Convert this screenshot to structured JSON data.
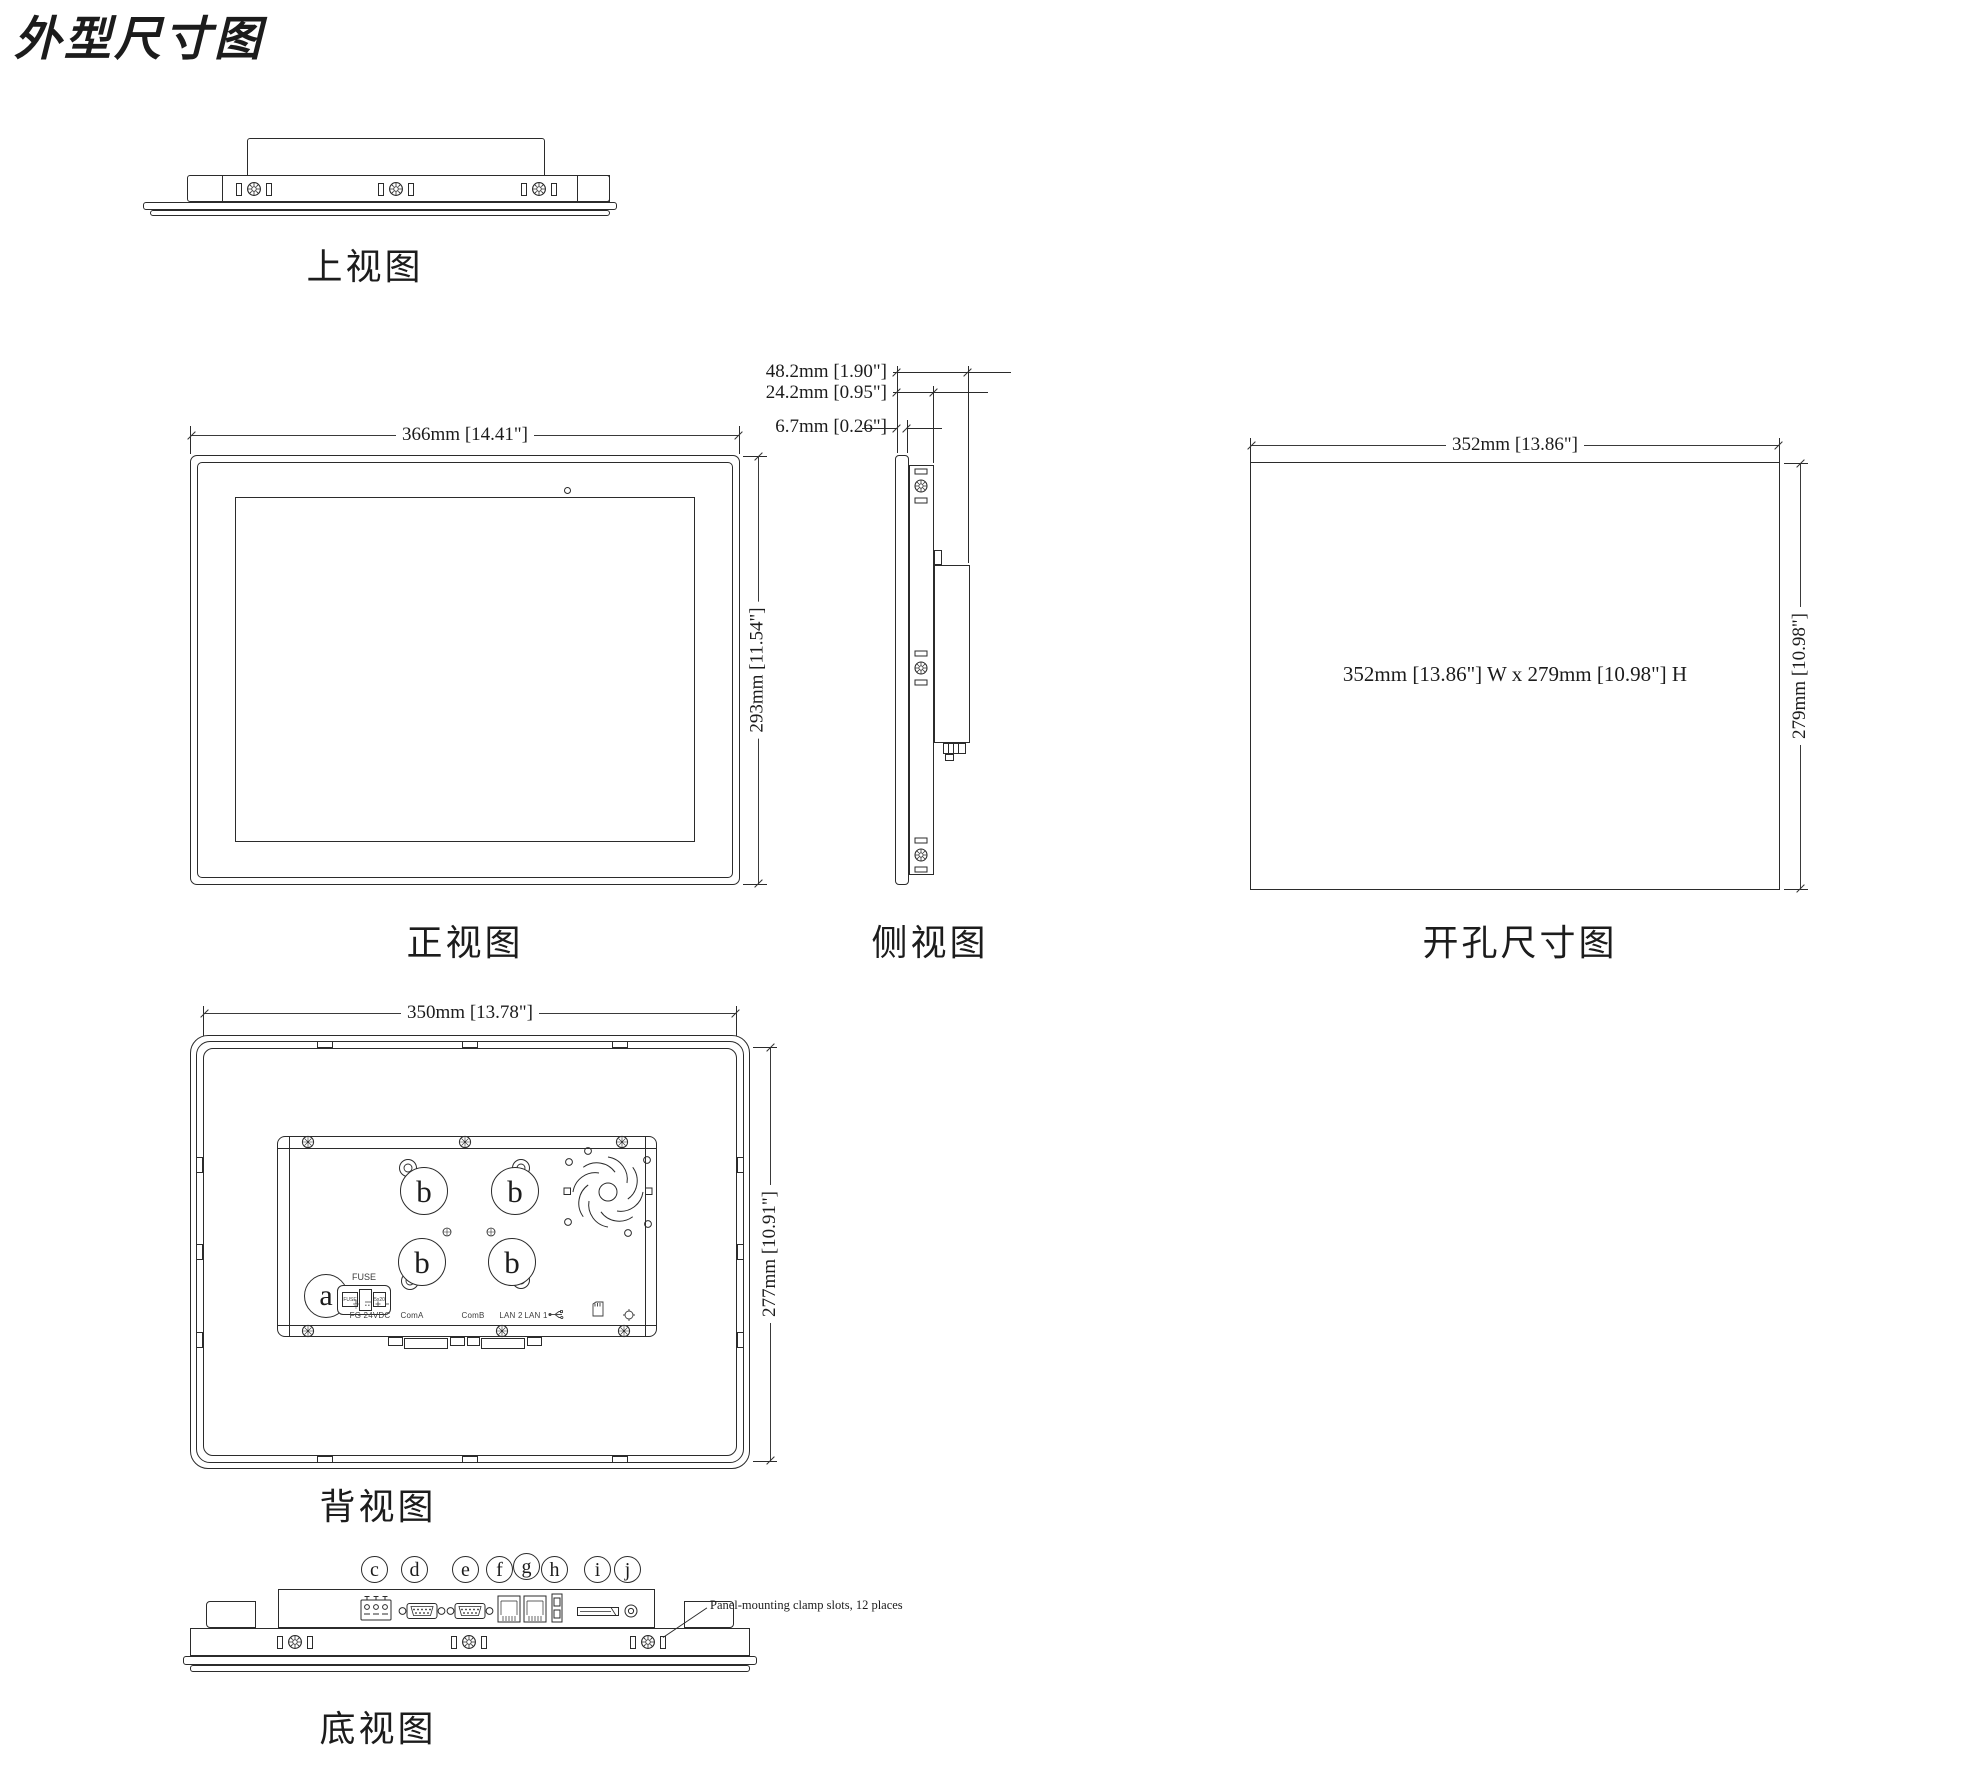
{
  "title": "外型尺寸图",
  "colors": {
    "ink": "#2b2b2b",
    "background": "#ffffff"
  },
  "views": {
    "top": {
      "label": "上视图"
    },
    "front": {
      "label": "正视图",
      "width_dim": "366mm [14.41\"]",
      "height_dim": "293mm [11.54\"]"
    },
    "side": {
      "label": "侧视图",
      "total_depth_dim": "48.2mm [1.90\"]",
      "body_depth_dim": "24.2mm [0.95\"]",
      "bezel_depth_dim": "6.7mm [0.26\"]"
    },
    "cutout": {
      "label": "开孔尺寸图",
      "width_dim": "352mm [13.86\"]",
      "height_dim": "279mm [10.98\"]",
      "center_note": "352mm [13.86\"] W x 279mm [10.98\"] H"
    },
    "rear": {
      "label": "背视图",
      "width_dim": "350mm [13.78\"]",
      "height_dim": "277mm [10.91\"]",
      "callout_a": "a",
      "callout_b": "b",
      "fuse_title": "FUSE",
      "fuse_left": "FUSE",
      "fuse_right": "5x20",
      "ports": {
        "power": "FG  24VDC",
        "com_a": "ComA",
        "com_b": "ComB",
        "lan2": "LAN 2",
        "lan1": "LAN 1"
      }
    },
    "bottom": {
      "label": "底视图",
      "callouts": [
        "c",
        "d",
        "e",
        "f",
        "g",
        "h",
        "i",
        "j"
      ],
      "clamp_note": "Panel-mounting clamp slots, 12 places"
    }
  }
}
